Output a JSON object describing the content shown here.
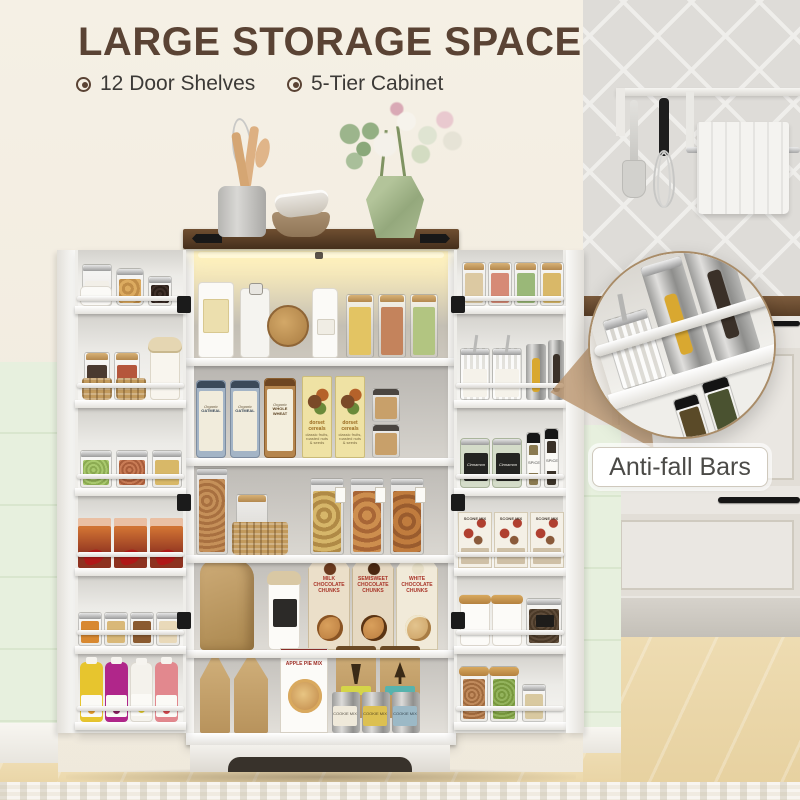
{
  "header": {
    "title": "LARGE STORAGE SPACE",
    "features": [
      {
        "label": "12 Door Shelves"
      },
      {
        "label": "5-Tier Cabinet"
      }
    ]
  },
  "callout": {
    "label": "Anti-fall Bars"
  },
  "products": {
    "oatmeal_brand": "Organic",
    "oatmeal_name": "OATMEAL",
    "wholewheat_brand": "Organic",
    "wholewheat_name": "WHOLE WHEAT",
    "dorset_name": "dorset cereals",
    "dorset_desc": "classic fruits, roasted nuts & seeds",
    "milk_chunks": "MILK CHOCOLATE CHUNKS",
    "semisweet_chunks": "SEMISWEET CHOCOLATE CHUNKS",
    "white_chunks": "WHITE CHOCOLATE CHUNKS",
    "apple_pie": "APPLE PIE MIX",
    "silver_cup": "SILVER CUP",
    "cookie_mix": "COOKIE MIX",
    "scone_mix": "SCONE MIX",
    "cinnamon": "Cinnamon",
    "spice": "SPICE"
  },
  "colors": {
    "title": "#5a4334",
    "wood_top": "#5d4128",
    "mint_wall": "#e7f0de",
    "cream_wall": "#f2ece0",
    "floor": "#ecd9ad",
    "led_glow": "#fdf3cd",
    "callout_ring": "#a98c68"
  }
}
